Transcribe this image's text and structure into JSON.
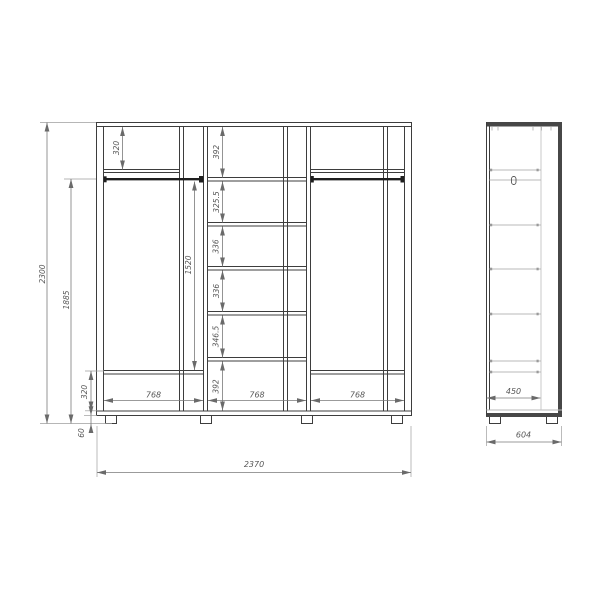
{
  "document": {
    "type": "furniture dimension drawing",
    "subject": "three-section wardrobe with shelves, drawers and hanging rods",
    "units": "mm",
    "views": [
      "front",
      "side"
    ]
  },
  "colors": {
    "background": "#ffffff",
    "carcass_line": "#3d3d3d",
    "dark_fill": "#474747",
    "rod": "#1f1f1f",
    "light_line": "#b8b8b8",
    "dimension_line": "#7a7a7a",
    "dimension_text": "#575757"
  },
  "front_view": {
    "overall_width": "2370",
    "overall_height": "2300",
    "hanging_zone_height": "1885",
    "rod_drop_height": "1520",
    "leg_height": "60",
    "section_widths": [
      "768",
      "768",
      "768"
    ],
    "left_section": {
      "top_shelf_drop": "320",
      "bottom_compartment_height": "320"
    },
    "middle_section": {
      "shelf_spacings": [
        "392",
        "325.5",
        "336",
        "336",
        "346.5"
      ],
      "bottom_compartment_height": "392"
    }
  },
  "side_view": {
    "inner_depth": "450",
    "overall_depth": "604"
  }
}
